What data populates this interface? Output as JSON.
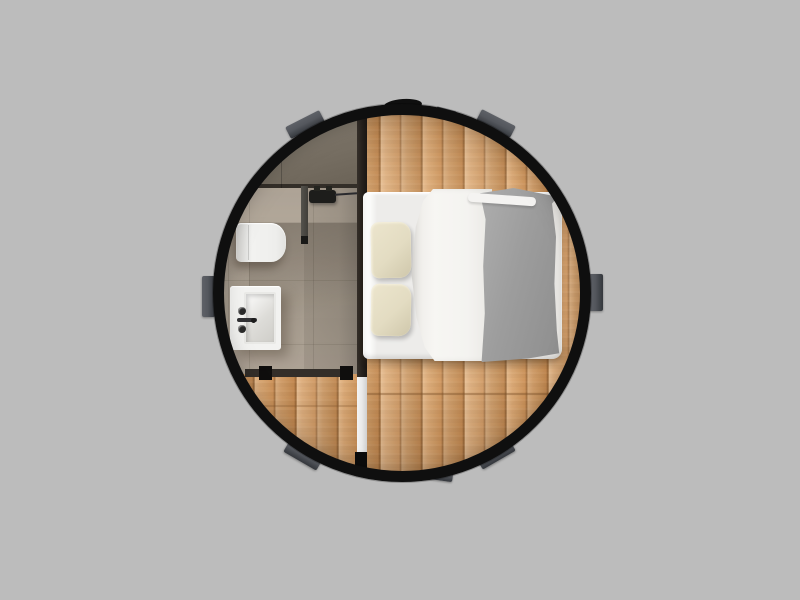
{
  "image": {
    "type": "3d-rendered-top-down-view",
    "subject": "circular pod cabin interior floor plan",
    "background": "plain gray studio backdrop",
    "text_content": "none"
  },
  "pod": {
    "shape": "circle",
    "wall": "thick black ring wall",
    "exterior_mounting_tabs": 7,
    "module_junction": "light vertical strip with black door pivot at bottom between left and right floor modules",
    "rooms": [
      {
        "name": "bedroom",
        "flooring": "light oak planks laid vertically",
        "items": [
          "double bed",
          "white duvet",
          "gray knit throw blanket over right half",
          "two cream pillows at head end",
          "shadow under bed foot"
        ]
      },
      {
        "name": "bathroom",
        "flooring": "beige porcelain tile with faint grout grid",
        "items": [
          "dark counter band along top",
          "wall-hung toilet",
          "rectangular basin with two faucet handles and spout",
          "shower glass panel with black overhead fixture",
          "glass wall with black end posts at bottom",
          "dark partition wall separating bathroom from bedroom"
        ]
      }
    ]
  },
  "palette": {
    "background": "#bcbcbc",
    "pod-wall": "#0f0f0f",
    "tab-metal": "#54575d",
    "wood-base": "#d8a369",
    "bathroom-tile": "#a89d8f",
    "bathroom-counter": "#7a7266",
    "mattress-white": "#edecea",
    "duvet-white": "#f7f6f3",
    "pillow-cream": "#e3dcc2",
    "blanket-gray": "#9c9c9c",
    "fixture-white": "#f2f2f0",
    "junction-strip": "#e9e9e9"
  }
}
